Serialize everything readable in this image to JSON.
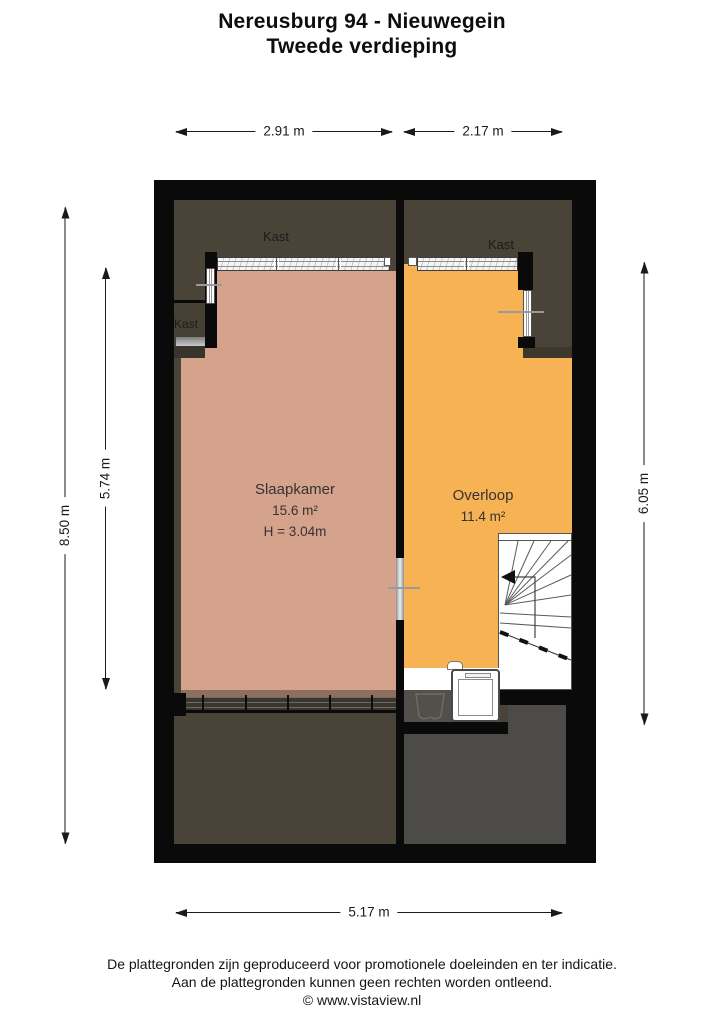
{
  "title": {
    "line1": "Nereusburg 94 - Nieuwegein",
    "line2": "Tweede verdieping"
  },
  "dimensions": {
    "top_left": "2.91 m",
    "top_right": "2.17 m",
    "left_outer": "8.50 m",
    "left_inner": "5.74 m",
    "right": "6.05 m",
    "bottom": "5.17 m"
  },
  "rooms": {
    "slaapkamer": {
      "name": "Slaapkamer",
      "area": "15.6 m²",
      "ceiling": "H = 3.04m"
    },
    "overloop": {
      "name": "Overloop",
      "area": "11.4 m²"
    }
  },
  "closet_labels": {
    "top_left": "Kast",
    "top_right": "Kast",
    "side_left": "Kast"
  },
  "footer": {
    "line1": "De plattegronden zijn geproduceerd voor promotionele doeleinden en ter indicatie.",
    "line2": "Aan de plattegronden kunnen geen rechten worden ontleend.",
    "line3": "© www.vistaview.nl"
  },
  "colors": {
    "bedroom_fill": "#d5a28c",
    "landing_fill": "#f7b254",
    "attic_fill": "#4a4438",
    "storage_gray_fill": "#4c4b48",
    "wall": "#0a0a0a"
  }
}
